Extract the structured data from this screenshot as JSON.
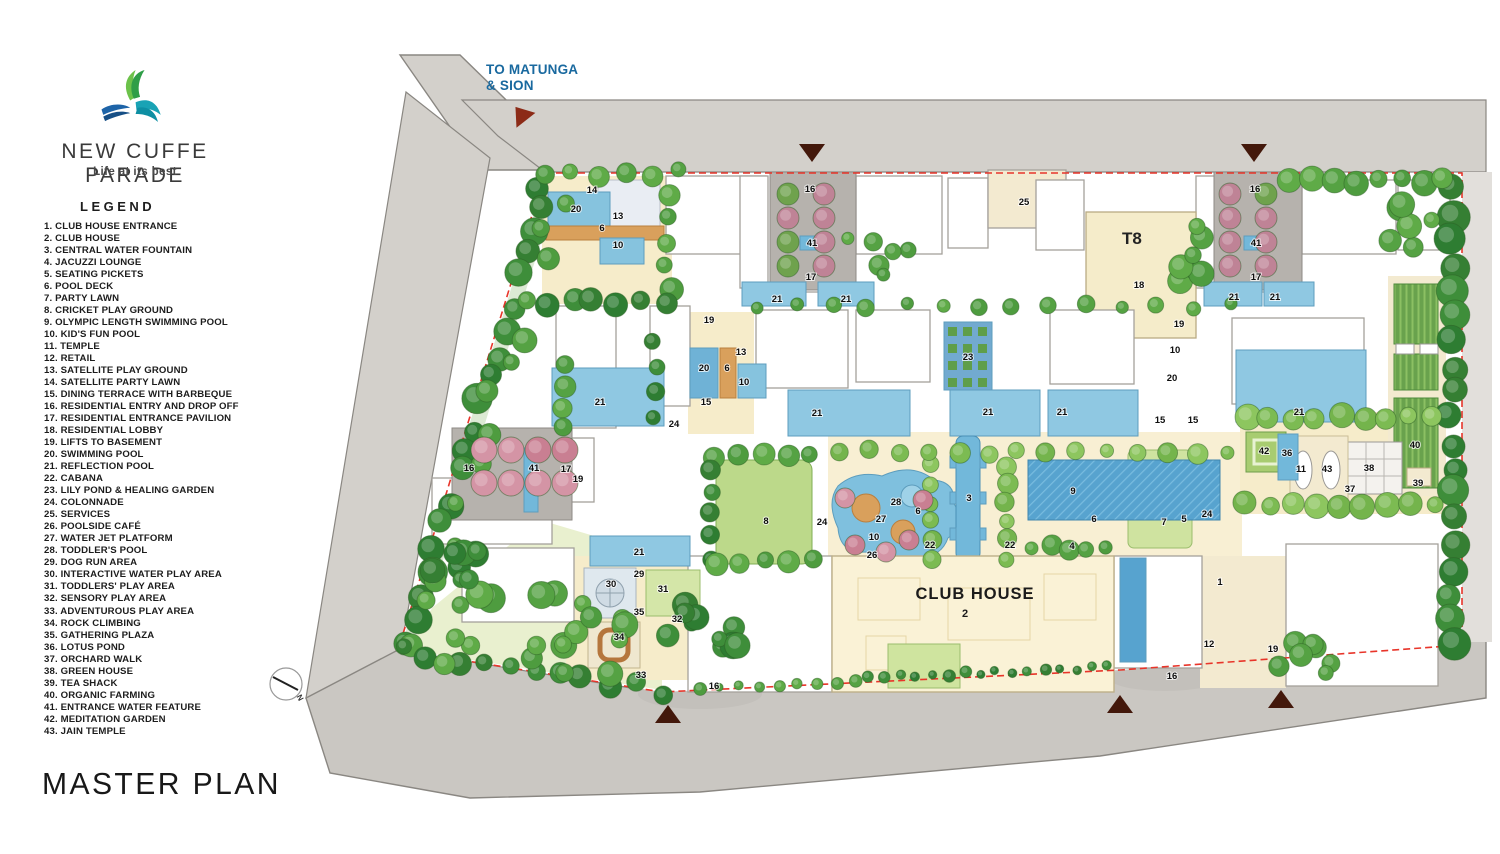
{
  "brand": {
    "name": "NEW CUFFE PARADE",
    "tagline": "Life at its best"
  },
  "page_title": "MASTER PLAN",
  "legend": {
    "title": "LEGEND",
    "items": [
      {
        "n": 1,
        "label": "CLUB HOUSE ENTRANCE"
      },
      {
        "n": 2,
        "label": "CLUB HOUSE"
      },
      {
        "n": 3,
        "label": "CENTRAL WATER FOUNTAIN"
      },
      {
        "n": 4,
        "label": "JACUZZI LOUNGE"
      },
      {
        "n": 5,
        "label": "SEATING PICKETS"
      },
      {
        "n": 6,
        "label": "POOL DECK"
      },
      {
        "n": 7,
        "label": "PARTY LAWN"
      },
      {
        "n": 8,
        "label": "CRICKET PLAY GROUND"
      },
      {
        "n": 9,
        "label": "OLYMPIC LENGTH SWIMMING POOL"
      },
      {
        "n": 10,
        "label": "KID'S FUN POOL"
      },
      {
        "n": 11,
        "label": "TEMPLE"
      },
      {
        "n": 12,
        "label": "RETAIL"
      },
      {
        "n": 13,
        "label": "SATELLITE PLAY GROUND"
      },
      {
        "n": 14,
        "label": "SATELLITE PARTY LAWN"
      },
      {
        "n": 15,
        "label": "DINING TERRACE WITH BARBEQUE"
      },
      {
        "n": 16,
        "label": "RESIDENTIAL ENTRY AND DROP OFF"
      },
      {
        "n": 17,
        "label": "RESIDENTIAL ENTRANCE PAVILION"
      },
      {
        "n": 18,
        "label": "RESIDENTIAL LOBBY"
      },
      {
        "n": 19,
        "label": "LIFTS TO BASEMENT"
      },
      {
        "n": 20,
        "label": "SWIMMING POOL"
      },
      {
        "n": 21,
        "label": "REFLECTION POOL"
      },
      {
        "n": 22,
        "label": "CABANA"
      },
      {
        "n": 23,
        "label": "LILY POND & HEALING GARDEN"
      },
      {
        "n": 24,
        "label": "COLONNADE"
      },
      {
        "n": 25,
        "label": "SERVICES"
      },
      {
        "n": 26,
        "label": "POOLSIDE CAFÉ"
      },
      {
        "n": 27,
        "label": "WATER JET PLATFORM"
      },
      {
        "n": 28,
        "label": "TODDLER'S POOL"
      },
      {
        "n": 29,
        "label": "DOG RUN AREA"
      },
      {
        "n": 30,
        "label": "INTERACTIVE WATER PLAY AREA"
      },
      {
        "n": 31,
        "label": "TODDLERS' PLAY AREA"
      },
      {
        "n": 32,
        "label": "SENSORY PLAY AREA"
      },
      {
        "n": 33,
        "label": "ADVENTUROUS PLAY AREA"
      },
      {
        "n": 34,
        "label": "ROCK CLIMBING"
      },
      {
        "n": 35,
        "label": "GATHERING PLAZA"
      },
      {
        "n": 36,
        "label": "LOTUS POND"
      },
      {
        "n": 37,
        "label": "ORCHARD WALK"
      },
      {
        "n": 38,
        "label": "GREEN HOUSE"
      },
      {
        "n": 39,
        "label": "TEA SHACK"
      },
      {
        "n": 40,
        "label": "ORGANIC FARMING"
      },
      {
        "n": 41,
        "label": "ENTRANCE WATER FEATURE"
      },
      {
        "n": 42,
        "label": "MEDITATION GARDEN"
      },
      {
        "n": 43,
        "label": "JAIN TEMPLE"
      }
    ]
  },
  "plan": {
    "road_label_line1": "TO MATUNGA",
    "road_label_line2": "& SION",
    "club_house": {
      "label": "CLUB HOUSE",
      "number": "2"
    },
    "t8_label": "T8",
    "compass_label": "N",
    "markers": [
      {
        "x": 592,
        "y": 193,
        "t": "14"
      },
      {
        "x": 576,
        "y": 212,
        "t": "20"
      },
      {
        "x": 618,
        "y": 219,
        "t": "13"
      },
      {
        "x": 602,
        "y": 231,
        "t": "6"
      },
      {
        "x": 618,
        "y": 248,
        "t": "10"
      },
      {
        "x": 810,
        "y": 192,
        "t": "16"
      },
      {
        "x": 812,
        "y": 246,
        "t": "41"
      },
      {
        "x": 811,
        "y": 280,
        "t": "17"
      },
      {
        "x": 777,
        "y": 302,
        "t": "21"
      },
      {
        "x": 846,
        "y": 302,
        "t": "21"
      },
      {
        "x": 1024,
        "y": 205,
        "t": "25"
      },
      {
        "x": 1139,
        "y": 288,
        "t": "18"
      },
      {
        "x": 1255,
        "y": 192,
        "t": "16"
      },
      {
        "x": 1256,
        "y": 246,
        "t": "41"
      },
      {
        "x": 1256,
        "y": 280,
        "t": "17"
      },
      {
        "x": 1234,
        "y": 300,
        "t": "21"
      },
      {
        "x": 1275,
        "y": 300,
        "t": "21"
      },
      {
        "x": 709,
        "y": 323,
        "t": "19"
      },
      {
        "x": 741,
        "y": 355,
        "t": "13"
      },
      {
        "x": 704,
        "y": 371,
        "t": "20"
      },
      {
        "x": 727,
        "y": 371,
        "t": "6"
      },
      {
        "x": 744,
        "y": 385,
        "t": "10"
      },
      {
        "x": 706,
        "y": 405,
        "t": "15"
      },
      {
        "x": 674,
        "y": 427,
        "t": "24"
      },
      {
        "x": 600,
        "y": 405,
        "t": "21"
      },
      {
        "x": 817,
        "y": 416,
        "t": "21"
      },
      {
        "x": 988,
        "y": 415,
        "t": "21"
      },
      {
        "x": 1062,
        "y": 415,
        "t": "21"
      },
      {
        "x": 1299,
        "y": 415,
        "t": "21"
      },
      {
        "x": 1179,
        "y": 327,
        "t": "19"
      },
      {
        "x": 1175,
        "y": 353,
        "t": "10"
      },
      {
        "x": 1172,
        "y": 381,
        "t": "20"
      },
      {
        "x": 1160,
        "y": 423,
        "t": "15"
      },
      {
        "x": 1193,
        "y": 423,
        "t": "15"
      },
      {
        "x": 968,
        "y": 360,
        "t": "23"
      },
      {
        "x": 469,
        "y": 471,
        "t": "16"
      },
      {
        "x": 534,
        "y": 471,
        "t": "41"
      },
      {
        "x": 566,
        "y": 472,
        "t": "17"
      },
      {
        "x": 578,
        "y": 482,
        "t": "19"
      },
      {
        "x": 639,
        "y": 555,
        "t": "21"
      },
      {
        "x": 896,
        "y": 505,
        "t": "28"
      },
      {
        "x": 881,
        "y": 522,
        "t": "27"
      },
      {
        "x": 874,
        "y": 540,
        "t": "10"
      },
      {
        "x": 872,
        "y": 558,
        "t": "26"
      },
      {
        "x": 918,
        "y": 514,
        "t": "6"
      },
      {
        "x": 930,
        "y": 548,
        "t": "22"
      },
      {
        "x": 1010,
        "y": 548,
        "t": "22"
      },
      {
        "x": 969,
        "y": 501,
        "t": "3"
      },
      {
        "x": 1073,
        "y": 494,
        "t": "9"
      },
      {
        "x": 1094,
        "y": 522,
        "t": "6"
      },
      {
        "x": 1072,
        "y": 549,
        "t": "4"
      },
      {
        "x": 822,
        "y": 525,
        "t": "24"
      },
      {
        "x": 1207,
        "y": 517,
        "t": "24"
      },
      {
        "x": 1164,
        "y": 525,
        "t": "7"
      },
      {
        "x": 1184,
        "y": 522,
        "t": "5"
      },
      {
        "x": 766,
        "y": 524,
        "t": "8"
      },
      {
        "x": 639,
        "y": 577,
        "t": "29"
      },
      {
        "x": 611,
        "y": 587,
        "t": "30"
      },
      {
        "x": 663,
        "y": 592,
        "t": "31"
      },
      {
        "x": 677,
        "y": 622,
        "t": "32"
      },
      {
        "x": 639,
        "y": 615,
        "t": "35"
      },
      {
        "x": 619,
        "y": 640,
        "t": "34"
      },
      {
        "x": 641,
        "y": 678,
        "t": "33"
      },
      {
        "x": 714,
        "y": 689,
        "t": "16"
      },
      {
        "x": 1172,
        "y": 679,
        "t": "16"
      },
      {
        "x": 1220,
        "y": 585,
        "t": "1"
      },
      {
        "x": 1209,
        "y": 647,
        "t": "12"
      },
      {
        "x": 1273,
        "y": 652,
        "t": "19"
      },
      {
        "x": 1264,
        "y": 454,
        "t": "42"
      },
      {
        "x": 1287,
        "y": 456,
        "t": "36"
      },
      {
        "x": 1301,
        "y": 472,
        "t": "11"
      },
      {
        "x": 1327,
        "y": 472,
        "t": "43"
      },
      {
        "x": 1369,
        "y": 471,
        "t": "38"
      },
      {
        "x": 1415,
        "y": 448,
        "t": "40"
      },
      {
        "x": 1418,
        "y": 486,
        "t": "39"
      },
      {
        "x": 1350,
        "y": 492,
        "t": "37"
      }
    ],
    "entrances": [
      {
        "x": 521,
        "y": 114,
        "dir": "ne"
      },
      {
        "x": 812,
        "y": 153,
        "dir": "down"
      },
      {
        "x": 1254,
        "y": 153,
        "dir": "down"
      },
      {
        "x": 668,
        "y": 714,
        "dir": "up"
      },
      {
        "x": 1120,
        "y": 704,
        "dir": "up"
      },
      {
        "x": 1281,
        "y": 699,
        "dir": "up"
      }
    ]
  },
  "colors": {
    "accent_blue": "#19699f",
    "boundary_red": "#e8352a",
    "road_gray": "#d3d0cb",
    "pool_blue": "#86c3de",
    "deep_pool": "#57a3cf",
    "lawn_green": "#cfe3a0",
    "cream_deck": "#f6ecca",
    "tree_green": "#4e9c3f",
    "entrance_marker": "#43180b"
  }
}
